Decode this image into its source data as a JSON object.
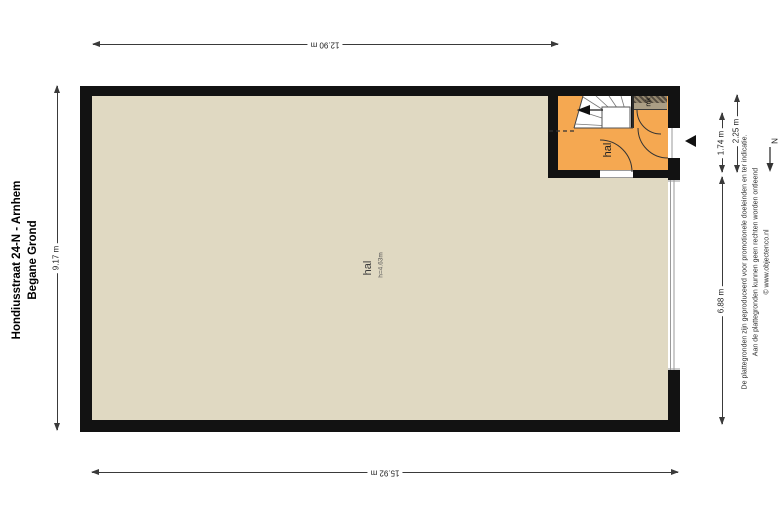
{
  "title": {
    "line1": "Hondiusstraat 24-N - Arnhem",
    "line2": "Begane Grond"
  },
  "rooms": {
    "main": {
      "label": "hal",
      "height": "h=4.63m",
      "color": "#E0D9C2"
    },
    "entrance": {
      "label": "hal",
      "color": "#F5A851"
    },
    "mk": {
      "label": "mk",
      "color": "#AB9E85"
    }
  },
  "dimensions": {
    "top": "12.90 m",
    "bottom": "15.92 m",
    "left": "9.17 m",
    "right_outer": "2.25 m",
    "right_inner_upper": "1.74 m",
    "right_inner_lower": "6.88 m"
  },
  "compass": {
    "label": "N"
  },
  "disclaimer": {
    "line1": "De plattegronden zijn geproduceerd voor promotionele doeleinden en ter indicatie.",
    "line2": "Aan de plattegronden kunnen geen rechten worden ontleend",
    "line3": "© www.objectenco.nl"
  },
  "colors": {
    "wall": "#121212",
    "main_room_fill": "#E0D9C2",
    "entrance_hall_fill": "#F5A851",
    "mk_fill": "#AB9E85",
    "dimension_line": "#3a3a3a"
  }
}
